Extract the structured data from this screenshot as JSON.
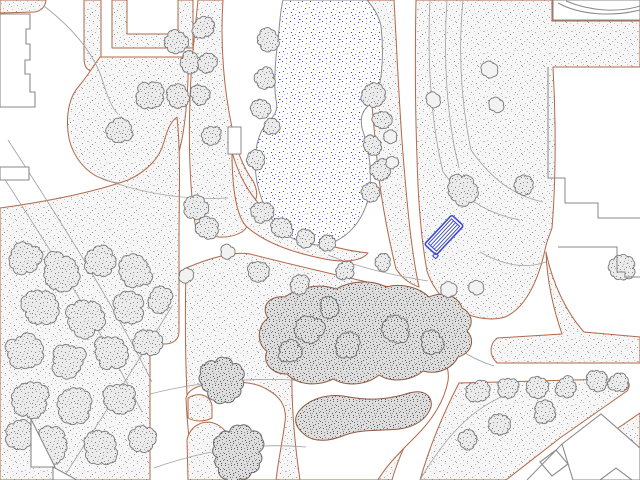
{
  "map": {
    "canvas": {
      "width": 640,
      "height": 480
    },
    "palette": {
      "background": "#ffffff",
      "ground_edge": "#b26847",
      "building_edge": "#8a8a8a",
      "contour": "#a0a0a0",
      "tree_edge": "#787878",
      "shrub_edge": "#8c5a42",
      "pond_edge": "#8a8a8a",
      "bench_blue": "#3b49c6",
      "water_dot": "#3434d2"
    },
    "grounds": [
      {
        "name": "planting-area-topleft-band",
        "d": "M0,0 L46,0 Q45,10 35,12 L0,13 Z"
      },
      {
        "name": "planting-area-strip",
        "d": "M84,0 L101,0 L101,58 Q101,70 92,71 Q84,70 84,58 Z"
      },
      {
        "name": "planting-area-ustrip",
        "d": "M112,0 L127,0 L127,34 L178,34 L178,0 L193,0 L193,48 L112,48 Z"
      },
      {
        "name": "planting-area-midtop",
        "d": "M198,0 L223,0 C220,45 224,92 233,132 C237,152 243,167 253,181 C259,193 258,201 249,206 C252,216 250,226 242,232 C228,240 210,238 196,230 C188,180 188,120 192,60 C194,40 196,20 198,0 Z"
      },
      {
        "name": "planting-area-midtop2",
        "d": "M100,57 L188,57 L188,80 C186,125 181,155 170,175 C150,190 116,186 96,176 C82,168 70,152 68,132 C66,112 70,96 79,86 C86,78 92,68 100,57 Z"
      },
      {
        "name": "planting-area-leftmass",
        "d": "M0,208 C45,202 95,192 128,180 C148,171 160,157 164,142 C167,130 171,121 177,117 C181,155 179,200 179,240 L179,332 C179,340 172,344 165,344 L150,344 L150,480 L0,480 Z"
      },
      {
        "name": "planting-area-center",
        "d": "M186,268 C212,257 236,251 250,254 C305,268 362,281 416,293 C433,298 444,309 448,323 C452,346 448,368 438,384 C422,412 402,445 392,480 L200,480 C194,450 189,420 187,395 C185,350 185,310 186,268 Z"
      },
      {
        "name": "planting-area-shore-sw",
        "d": "M232,152 C239,176 248,192 261,206 C276,221 293,231 311,239 C330,247 350,251 368,253 C361,262 341,263 320,258 C291,252 264,242 247,227 C236,217 232,186 232,152 Z"
      },
      {
        "name": "planting-area-shore-e",
        "d": "M367,0 L394,0 C397,52 399,104 403,154 C407,203 411,250 419,287 C410,284 402,278 396,269 C389,240 383,209 379,179 C373,120 367,60 367,0 Z"
      },
      {
        "name": "planting-area-right",
        "d": "M416,0 L552,0 L552,21 L640,21 L640,67 L553,67 C556,120 556,180 552,228 C549,237 546,243 545,250 C536,290 521,310 505,317 C488,322 469,317 452,307 C440,297 431,284 427,271 C421,238 418,198 417,158 C415,104 415,52 416,0 Z"
      },
      {
        "name": "planting-area-right-wedge",
        "d": "M546,252 C552,282 566,312 584,332 L640,337 L640,363 L497,363 C489,355 489,345 497,338 L562,334 C553,308 547,280 546,252 Z"
      },
      {
        "name": "planting-area-bottomright-triangle",
        "d": "M459,383 L612,379 C626,377 633,382 627,391 L560,438 L506,480 L420,480 C430,445 444,412 459,383 Z"
      },
      {
        "name": "planting-area-right-small-triangle",
        "d": "M640,413 L640,450 L586,450 Z"
      }
    ],
    "plazas": [
      {
        "name": "plaza-bottom-left",
        "d": "M186,398 C188,390 196,386 208,384 C236,380 256,382 268,390 C281,397 287,408 285,422 C282,444 278,462 276,480 L196,480 C190,452 187,424 186,398 Z"
      },
      {
        "name": "plaza-bottom-center",
        "d": "M292,360 C340,352 390,348 428,350 C443,354 450,366 448,381 C444,402 432,420 416,436 C400,452 386,466 378,480 L300,480 C294,440 291,400 292,360 Z"
      }
    ],
    "grounds2": [
      {
        "name": "planting-island-a",
        "d": "M187,440 C190,425 205,418 218,425 C230,432 236,446 235,462 L234,480 L188,480 Z"
      },
      {
        "name": "planting-island-b",
        "d": "M188,398 C198,392 210,394 212,406 L212,418 C204,422 195,422 188,418 Z"
      }
    ],
    "contours": [
      {
        "name": "contour-line",
        "d": "M44,6 C75,30 95,55 103,82 C108,98 112,108 118,114"
      },
      {
        "name": "contour-line",
        "d": "M8,140 C60,220 112,302 152,382"
      },
      {
        "name": "contour-line",
        "d": "M0,172 C52,252 102,332 142,412"
      },
      {
        "name": "contour-line",
        "d": "M62,480 C100,420 138,362 172,306"
      },
      {
        "name": "contour-line",
        "d": "M430,0 C427,60 431,122 443,172"
      },
      {
        "name": "contour-line",
        "d": "M447,0 C443,60 447,120 459,168"
      },
      {
        "name": "contour-line",
        "d": "M463,0 C458,52 461,102 471,150"
      },
      {
        "name": "contour-line",
        "d": "M443,172 C462,198 488,214 520,220"
      },
      {
        "name": "contour-line",
        "d": "M471,150 C492,180 515,196 543,202"
      },
      {
        "name": "contour-line",
        "d": "M480,252 C505,266 526,269 546,262"
      },
      {
        "name": "contour-line",
        "d": "M150,394 C205,380 262,377 305,381"
      },
      {
        "name": "contour-line",
        "d": "M154,468 C210,448 262,443 306,447"
      },
      {
        "name": "contour-line",
        "d": "M428,318 C448,344 468,358 494,366"
      },
      {
        "name": "contour-line",
        "d": "M420,480 C448,432 478,402 518,391"
      },
      {
        "name": "contour-line",
        "d": "M96,176 C140,194 185,200 228,198"
      },
      {
        "name": "contour-line",
        "d": "M328,255 C360,268 396,276 428,281"
      }
    ],
    "pond": {
      "name": "pond",
      "d": "M283,0 L367,0 C374,8 379,16 381,26 C383,44 383,60 381,76 C379,90 375,100 368,106 C362,112 360,118 362,128 C366,140 369,152 370,165 C371,182 370,196 366,206 C360,222 350,234 336,241 C322,247 306,246 292,238 C278,230 268,216 262,200 C256,184 254,166 256,150 C258,136 263,126 270,120 C276,114 278,108 276,100 C273,80 276,55 279,30 C280,18 281,8 283,0 Z"
    },
    "dock": {
      "name": "pond-steps",
      "x": 228,
      "y": 127,
      "w": 13,
      "h": 27
    },
    "shrubs": [
      {
        "name": "shrub-mass-center",
        "d": "M268,318 C260,306 270,295 285,297 C298,287 320,283 336,289 C350,281 371,279 386,287 C401,283 419,287 429,297 C442,291 458,295 462,308 C472,313 474,324 467,331 C476,341 471,353 458,357 C452,369 437,375 423,371 C411,381 392,383 379,375 C367,385 347,387 333,379 C317,387 297,385 287,374 C272,374 262,363 267,351 C257,345 256,327 268,318 Z"
      },
      {
        "name": "shrub-hedge-s",
        "d": "M299,411 C311,397 331,393 349,397 C371,401 391,399 409,393 C423,389 433,395 431,407 C427,419 415,427 399,429 C381,431 361,429 345,435 C331,441 315,443 305,435 C295,427 293,419 299,411 Z"
      }
    ],
    "trees": [
      [
        25,
        258,
        16,
        "d"
      ],
      [
        60,
        272,
        18,
        "d"
      ],
      [
        100,
        262,
        15,
        "d"
      ],
      [
        135,
        272,
        16,
        "d"
      ],
      [
        40,
        308,
        17,
        "d"
      ],
      [
        85,
        318,
        18,
        "d"
      ],
      [
        128,
        308,
        15,
        "d"
      ],
      [
        160,
        300,
        12,
        "d"
      ],
      [
        25,
        352,
        18,
        "d"
      ],
      [
        68,
        360,
        17,
        "d"
      ],
      [
        110,
        352,
        16,
        "d"
      ],
      [
        148,
        342,
        13,
        "d"
      ],
      [
        30,
        400,
        18,
        "d"
      ],
      [
        75,
        405,
        17,
        "d"
      ],
      [
        120,
        398,
        15,
        "d"
      ],
      [
        50,
        445,
        17,
        "d"
      ],
      [
        100,
        448,
        16,
        "d"
      ],
      [
        142,
        438,
        13,
        "d"
      ],
      [
        20,
        435,
        14,
        "d"
      ],
      [
        150,
        95,
        13,
        "d"
      ],
      [
        176,
        42,
        11,
        "d"
      ],
      [
        190,
        62,
        10,
        "d"
      ],
      [
        178,
        95,
        11,
        "d"
      ],
      [
        120,
        130,
        12,
        "d"
      ],
      [
        203,
        28,
        10,
        "d"
      ],
      [
        207,
        62,
        9,
        "d"
      ],
      [
        200,
        95,
        9,
        "d"
      ],
      [
        212,
        135,
        9,
        "d"
      ],
      [
        196,
        208,
        11,
        "d"
      ],
      [
        207,
        228,
        10,
        "d"
      ],
      [
        268,
        40,
        11,
        "d"
      ],
      [
        265,
        78,
        10,
        "d"
      ],
      [
        261,
        108,
        9,
        "d"
      ],
      [
        272,
        126,
        8,
        "d"
      ],
      [
        256,
        160,
        9,
        "d"
      ],
      [
        262,
        212,
        10,
        "d"
      ],
      [
        282,
        228,
        10,
        "d"
      ],
      [
        305,
        238,
        9,
        "d"
      ],
      [
        328,
        243,
        8,
        "d"
      ],
      [
        373,
        95,
        11,
        "d"
      ],
      [
        382,
        120,
        9,
        "d"
      ],
      [
        372,
        145,
        9,
        "d"
      ],
      [
        381,
        170,
        10,
        "d"
      ],
      [
        371,
        192,
        9,
        "d"
      ],
      [
        462,
        190,
        15,
        "d"
      ],
      [
        525,
        185,
        9,
        "d"
      ],
      [
        622,
        268,
        12,
        "d"
      ],
      [
        258,
        272,
        10,
        "d"
      ],
      [
        300,
        284,
        9,
        "d"
      ],
      [
        345,
        270,
        9,
        "d"
      ],
      [
        383,
        262,
        8,
        "d"
      ],
      [
        478,
        392,
        11,
        "d"
      ],
      [
        508,
        388,
        10,
        "d"
      ],
      [
        538,
        387,
        10,
        "d"
      ],
      [
        566,
        387,
        10,
        "d"
      ],
      [
        597,
        380,
        10,
        "d"
      ],
      [
        618,
        383,
        9,
        "d"
      ],
      [
        545,
        412,
        10,
        "d"
      ],
      [
        500,
        424,
        10,
        "d"
      ],
      [
        468,
        440,
        9,
        "d"
      ],
      [
        592,
        446,
        8,
        "d"
      ],
      [
        310,
        330,
        13,
        "r"
      ],
      [
        348,
        346,
        12,
        "r"
      ],
      [
        395,
        330,
        13,
        "r"
      ],
      [
        432,
        342,
        11,
        "r"
      ],
      [
        290,
        352,
        11,
        "r"
      ],
      [
        330,
        308,
        10,
        "r"
      ],
      [
        390,
        137,
        6,
        "f"
      ],
      [
        392,
        162,
        6,
        "f"
      ],
      [
        433,
        100,
        7,
        "f"
      ],
      [
        489,
        70,
        8,
        "f"
      ],
      [
        497,
        105,
        7,
        "f"
      ],
      [
        448,
        290,
        8,
        "f"
      ],
      [
        476,
        287,
        7,
        "f"
      ],
      [
        186,
        275,
        7,
        "f"
      ],
      [
        228,
        252,
        7,
        "f"
      ],
      [
        222,
        379,
        20,
        "b"
      ],
      [
        237,
        452,
        26,
        "b"
      ]
    ],
    "buildings": [
      {
        "name": "building-topleft",
        "d": "M0,14 L30,14 L30,29 L26,29 L26,44 L30,44 L30,60 L25,60 L25,74 L30,74 L30,92 L35,92 L35,107 L0,107 Z"
      },
      {
        "name": "building-left-small",
        "d": "M0,167 L29,167 L29,180 L0,180 Z"
      },
      {
        "name": "building-topright",
        "d": "M553,0 L640,0 L640,20 L553,20 Z"
      },
      {
        "name": "building-bottomleft-a",
        "d": "M31,419 L31,467 L55,467 Z"
      },
      {
        "name": "building-bottomleft-b",
        "d": "M53,467 L77,480 L53,480 Z"
      },
      {
        "name": "building-bottomright-diamond",
        "d": "M562,444 L601,414 L640,448 L640,480 L573,480 Z"
      },
      {
        "name": "building-bottomright-small",
        "d": "M540,462 L556,450 L568,464 L552,476 Z"
      },
      {
        "name": "building-bottomright-corner",
        "d": "M600,480 L616,468 L632,480 Z"
      }
    ],
    "building_lines": [
      {
        "name": "building-step-outline",
        "d": "M548,67 L548,178 L565,178 L565,203 L598,203 L598,218 L640,218"
      },
      {
        "name": "building-step-outline",
        "d": "M558,247 L617,247 L617,272 L625,272 L625,277 L640,277"
      },
      {
        "name": "building-roof-curve",
        "d": "M558,3 C580,15 612,17 640,10"
      },
      {
        "name": "building-roof-curve",
        "d": "M566,1 C590,11 618,13 640,6"
      },
      {
        "name": "building-edge-line",
        "d": "M527,480 L562,444"
      }
    ],
    "bench": {
      "name": "bench-symbol",
      "cx": 444,
      "cy": 235,
      "w": 40,
      "h": 16,
      "angle": -47
    }
  }
}
